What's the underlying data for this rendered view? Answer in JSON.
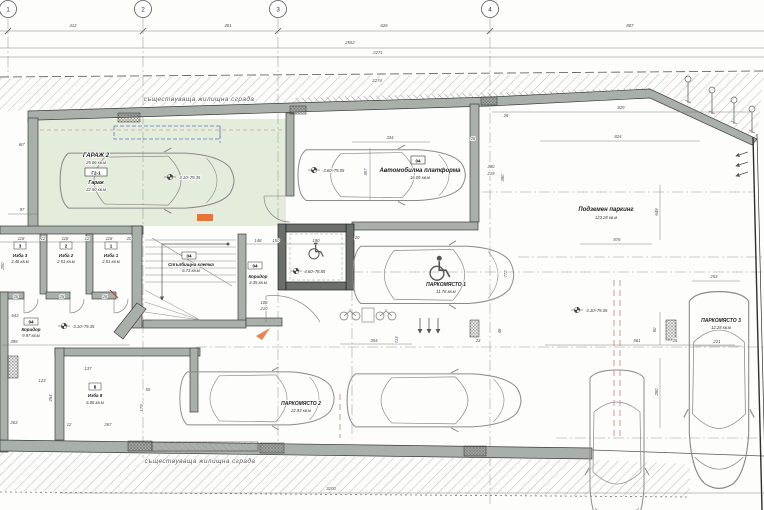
{
  "drawing": {
    "existing_building_top": "съществуваща жилищна сграда",
    "existing_building_bottom": "съществуваща жилищна сграда",
    "grid_bubbles": [
      "1",
      "2",
      "3",
      "4"
    ],
    "rooms": {
      "garage2": {
        "title": "ГАРАЖ 2",
        "title_area": "25.06 кв.м",
        "tag": "Г2-1",
        "name": "Гараж",
        "area": "22.50 кв.м",
        "level": "-3.10÷79.35"
      },
      "platform": {
        "tag": "04",
        "name": "Автомобилна платформа",
        "area": "16.05 кв.м",
        "level": "-3.60÷79.05"
      },
      "underground": {
        "name": "Подземен паркинг",
        "area": "123.28 кв.м",
        "level": "-3.10÷79.35"
      },
      "parking1": {
        "name": "ПАРКОМЯСТО 1",
        "area": "11.76 кв.м"
      },
      "parking2": {
        "name": "ПАРКОМЯСТО 2",
        "area": "22.93 кв.м"
      },
      "parking3": {
        "name": "ПАРКОМЯСТО 3",
        "area": "12.28 кв.м"
      },
      "izba3": {
        "tag": "3",
        "name": "Изба 3",
        "area": "2.46 кв.м"
      },
      "izba2": {
        "tag": "2",
        "name": "Изба 2",
        "area": "2.51 кв.м"
      },
      "izba1": {
        "tag": "1",
        "name": "Изба 1",
        "area": "2.51 кв.м"
      },
      "izba8": {
        "tag": "8",
        "name": "Изба 8",
        "area": "6.06 кв.м"
      },
      "corridor_left": {
        "tag": "04",
        "name": "Коридор",
        "area": "9.97 кв.м",
        "level": "-3.10÷79.35"
      },
      "corridor_mid": {
        "tag": "04",
        "name": "Коридор",
        "area": "4.35 кв.м"
      },
      "staircase": {
        "tag": "04",
        "name": "Стълбищна клетка",
        "area": "6.73 кв.м"
      },
      "lift": {
        "level": "-4.60÷78.85"
      }
    },
    "colors": {
      "garage_fill": "#e4ecdc",
      "wall": "#a9b0aa",
      "highlight": "#e8743c",
      "centerline_red": "#c66a6a"
    },
    "dim_labels": [
      {
        "t": "412",
        "x": 73,
        "y": 27
      },
      {
        "t": "401",
        "x": 228,
        "y": 27
      },
      {
        "t": "626",
        "x": 384,
        "y": 27
      },
      {
        "t": "807",
        "x": 630,
        "y": 27
      },
      {
        "t": "2552",
        "x": 350,
        "y": 44
      },
      {
        "t": "2271",
        "x": 378,
        "y": 54
      },
      {
        "t": "2274",
        "x": 377,
        "y": 82
      },
      {
        "t": "829",
        "x": 621,
        "y": 109
      },
      {
        "t": "824",
        "x": 618,
        "y": 138
      },
      {
        "t": "3100",
        "x": 331,
        "y": 490
      },
      {
        "t": "97",
        "x": 22,
        "y": 211
      },
      {
        "t": "60°",
        "x": 22,
        "y": 146
      },
      {
        "t": "334",
        "x": 390,
        "y": 139
      },
      {
        "t": "307",
        "x": 367,
        "y": 172,
        "r": -90
      },
      {
        "t": "28",
        "x": 473,
        "y": 140
      },
      {
        "t": "26",
        "x": 506,
        "y": 117
      },
      {
        "t": "380",
        "x": 491,
        "y": 168
      },
      {
        "t": "219",
        "x": 491,
        "y": 175
      },
      {
        "t": "390",
        "x": 504,
        "y": 178,
        "r": -90
      },
      {
        "t": "649",
        "x": 658,
        "y": 212,
        "r": -90
      },
      {
        "t": "876",
        "x": 617,
        "y": 241
      },
      {
        "t": "561",
        "x": 637,
        "y": 342
      },
      {
        "t": "772",
        "x": 507,
        "y": 274,
        "r": -90
      },
      {
        "t": "20",
        "x": 357,
        "y": 239
      },
      {
        "t": "253",
        "x": 714,
        "y": 278
      },
      {
        "t": "221",
        "x": 717,
        "y": 343
      },
      {
        "t": "280",
        "x": 658,
        "y": 392,
        "r": -90
      },
      {
        "t": "50",
        "x": 656,
        "y": 330,
        "r": -90
      },
      {
        "t": "25",
        "x": 675,
        "y": 342
      },
      {
        "t": "48",
        "x": 501,
        "y": 331,
        "r": -90
      },
      {
        "t": "23",
        "x": 478,
        "y": 342
      },
      {
        "t": "354",
        "x": 374,
        "y": 342
      },
      {
        "t": "713",
        "x": 398,
        "y": 340,
        "r": -90
      },
      {
        "t": "118",
        "x": 21,
        "y": 240
      },
      {
        "t": "12",
        "x": 43,
        "y": 240
      },
      {
        "t": "118",
        "x": 65,
        "y": 240
      },
      {
        "t": "12",
        "x": 87,
        "y": 240
      },
      {
        "t": "118",
        "x": 109,
        "y": 240
      },
      {
        "t": "20",
        "x": 129,
        "y": 240
      },
      {
        "t": "28",
        "x": 16,
        "y": 298
      },
      {
        "t": "28",
        "x": 62,
        "y": 298
      },
      {
        "t": "28",
        "x": 105,
        "y": 298
      },
      {
        "t": "643",
        "x": 15,
        "y": 317
      },
      {
        "t": "399",
        "x": 14,
        "y": 343
      },
      {
        "t": "200",
        "x": 4,
        "y": 266,
        "r": -90
      },
      {
        "t": "137",
        "x": 88,
        "y": 370
      },
      {
        "t": "123",
        "x": 42,
        "y": 382
      },
      {
        "t": "254",
        "x": 52,
        "y": 398,
        "r": -90
      },
      {
        "t": "55",
        "x": 148,
        "y": 391
      },
      {
        "t": "179",
        "x": 143,
        "y": 408,
        "r": -90
      },
      {
        "t": "263",
        "x": 14,
        "y": 424
      },
      {
        "t": "267",
        "x": 108,
        "y": 426
      },
      {
        "t": "12",
        "x": 69,
        "y": 426
      },
      {
        "t": "148",
        "x": 258,
        "y": 242
      },
      {
        "t": "150",
        "x": 276,
        "y": 242
      },
      {
        "t": "190",
        "x": 316,
        "y": 242
      },
      {
        "t": "108",
        "x": 264,
        "y": 304
      },
      {
        "t": "210",
        "x": 264,
        "y": 310
      }
    ]
  }
}
